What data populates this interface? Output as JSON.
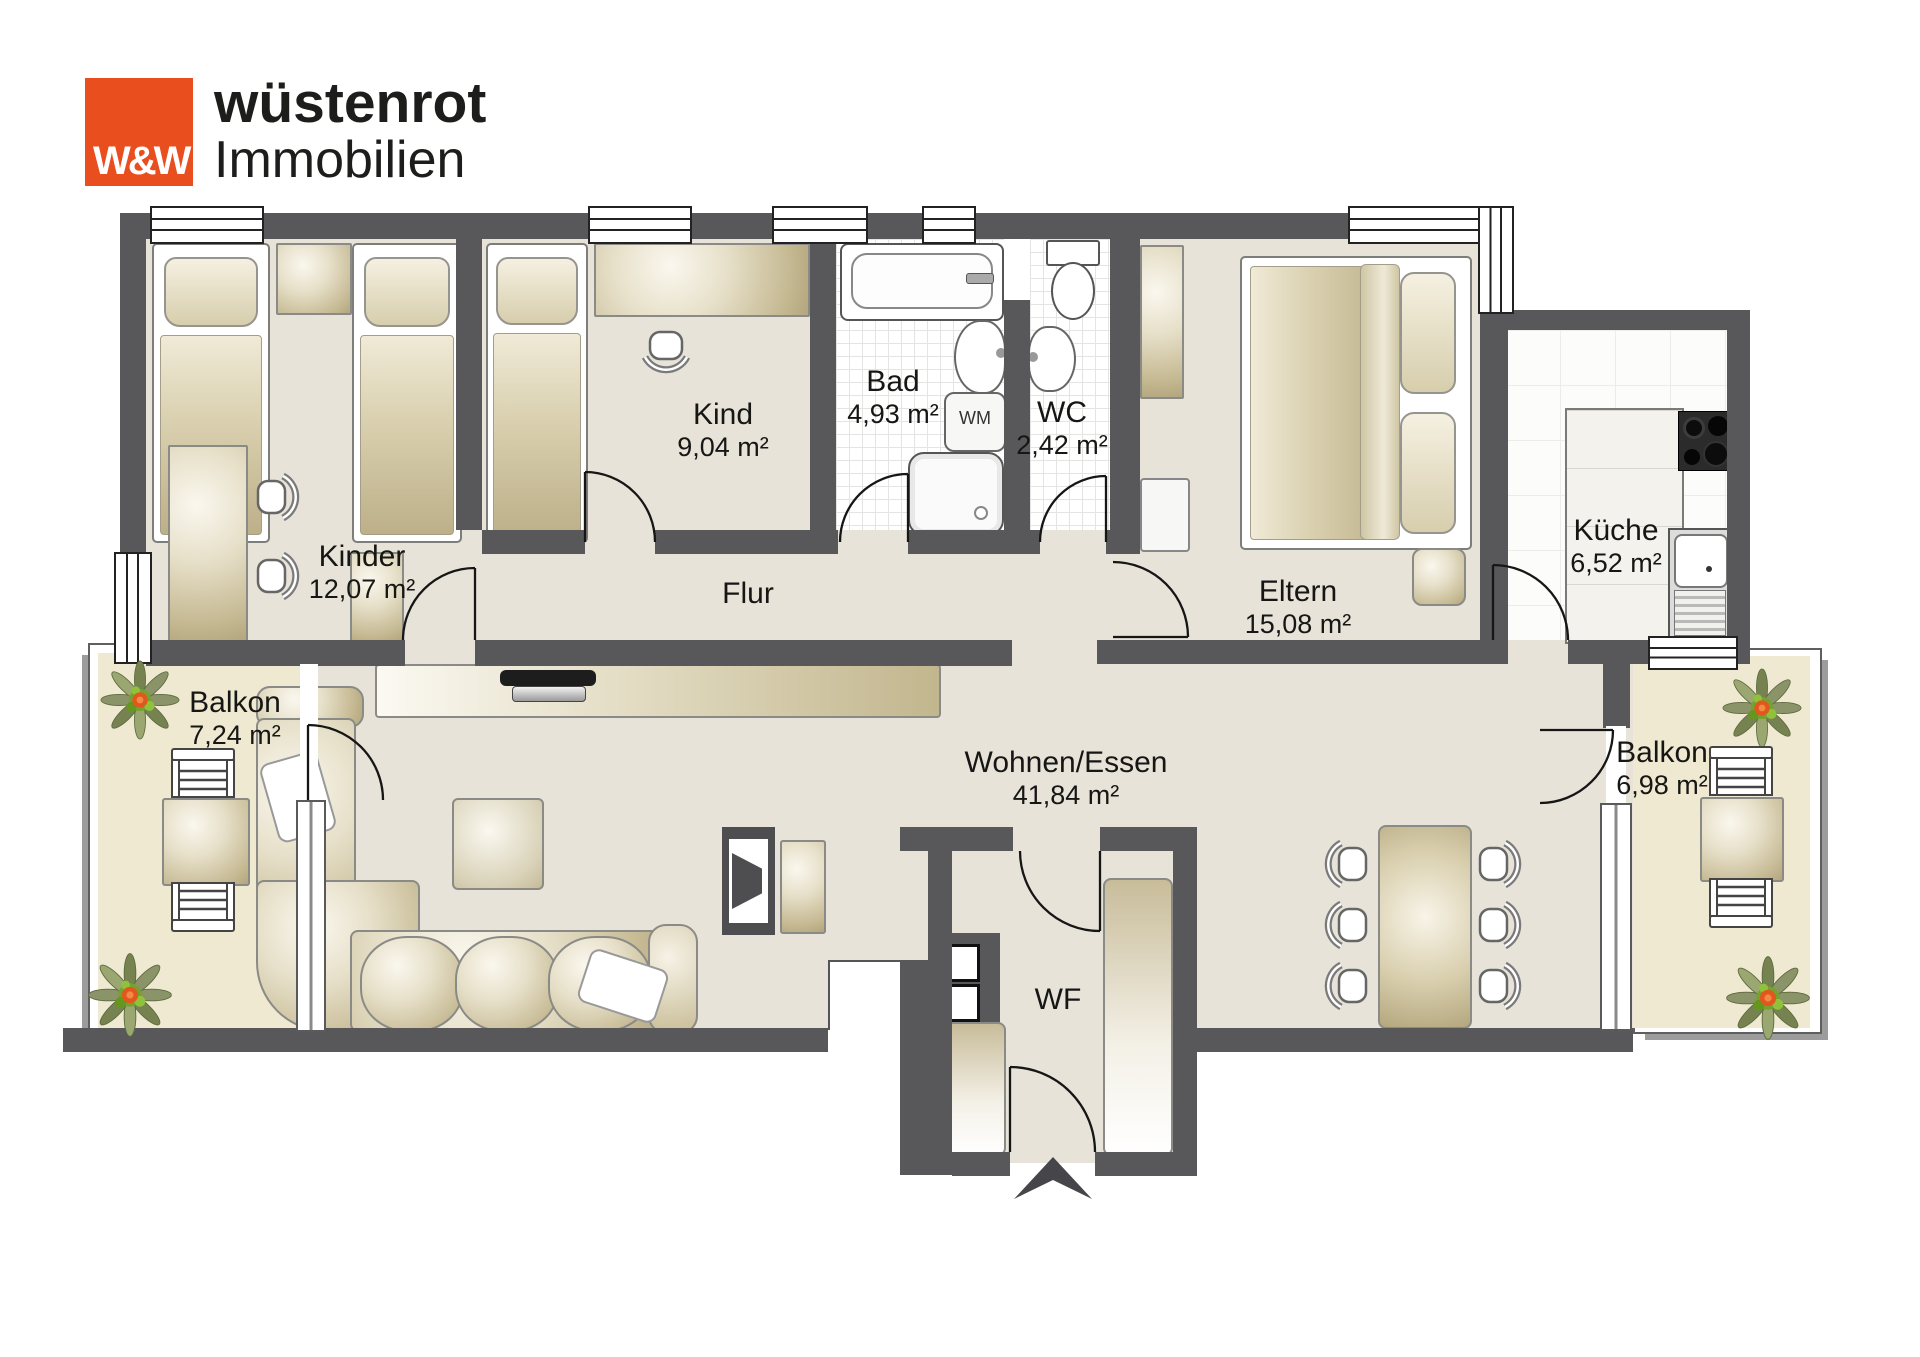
{
  "brand": {
    "logo_monogram": "W&W",
    "line1": "wüstenrot",
    "line2": "Immobilien",
    "logo_bg": "#e94e1f",
    "text_color": "#1d1d1b"
  },
  "rooms": {
    "kinder": {
      "name": "Kinder",
      "area": "12,07 m²"
    },
    "kind": {
      "name": "Kind",
      "area": "9,04 m²"
    },
    "bad": {
      "name": "Bad",
      "area": "4,93 m²"
    },
    "wc": {
      "name": "WC",
      "area": "2,42 m²"
    },
    "flur": {
      "name": "Flur"
    },
    "eltern": {
      "name": "Eltern",
      "area": "15,08 m²"
    },
    "kueche": {
      "name": "Küche",
      "area": "6,52 m²"
    },
    "wohnen_essen": {
      "name": "Wohnen/Essen",
      "area": "41,84 m²"
    },
    "wf": {
      "name": "WF"
    },
    "balkon_links": {
      "name": "Balkon",
      "area": "7,24 m²"
    },
    "balkon_rechts": {
      "name": "Balkon",
      "area": "6,98 m²"
    }
  },
  "appliances": {
    "wm": "WM"
  },
  "colors": {
    "wall": "#58585a",
    "floor": "#e7e3d8",
    "balcony_floor": "#efe9d2",
    "accent_orange": "#e94e1f"
  }
}
